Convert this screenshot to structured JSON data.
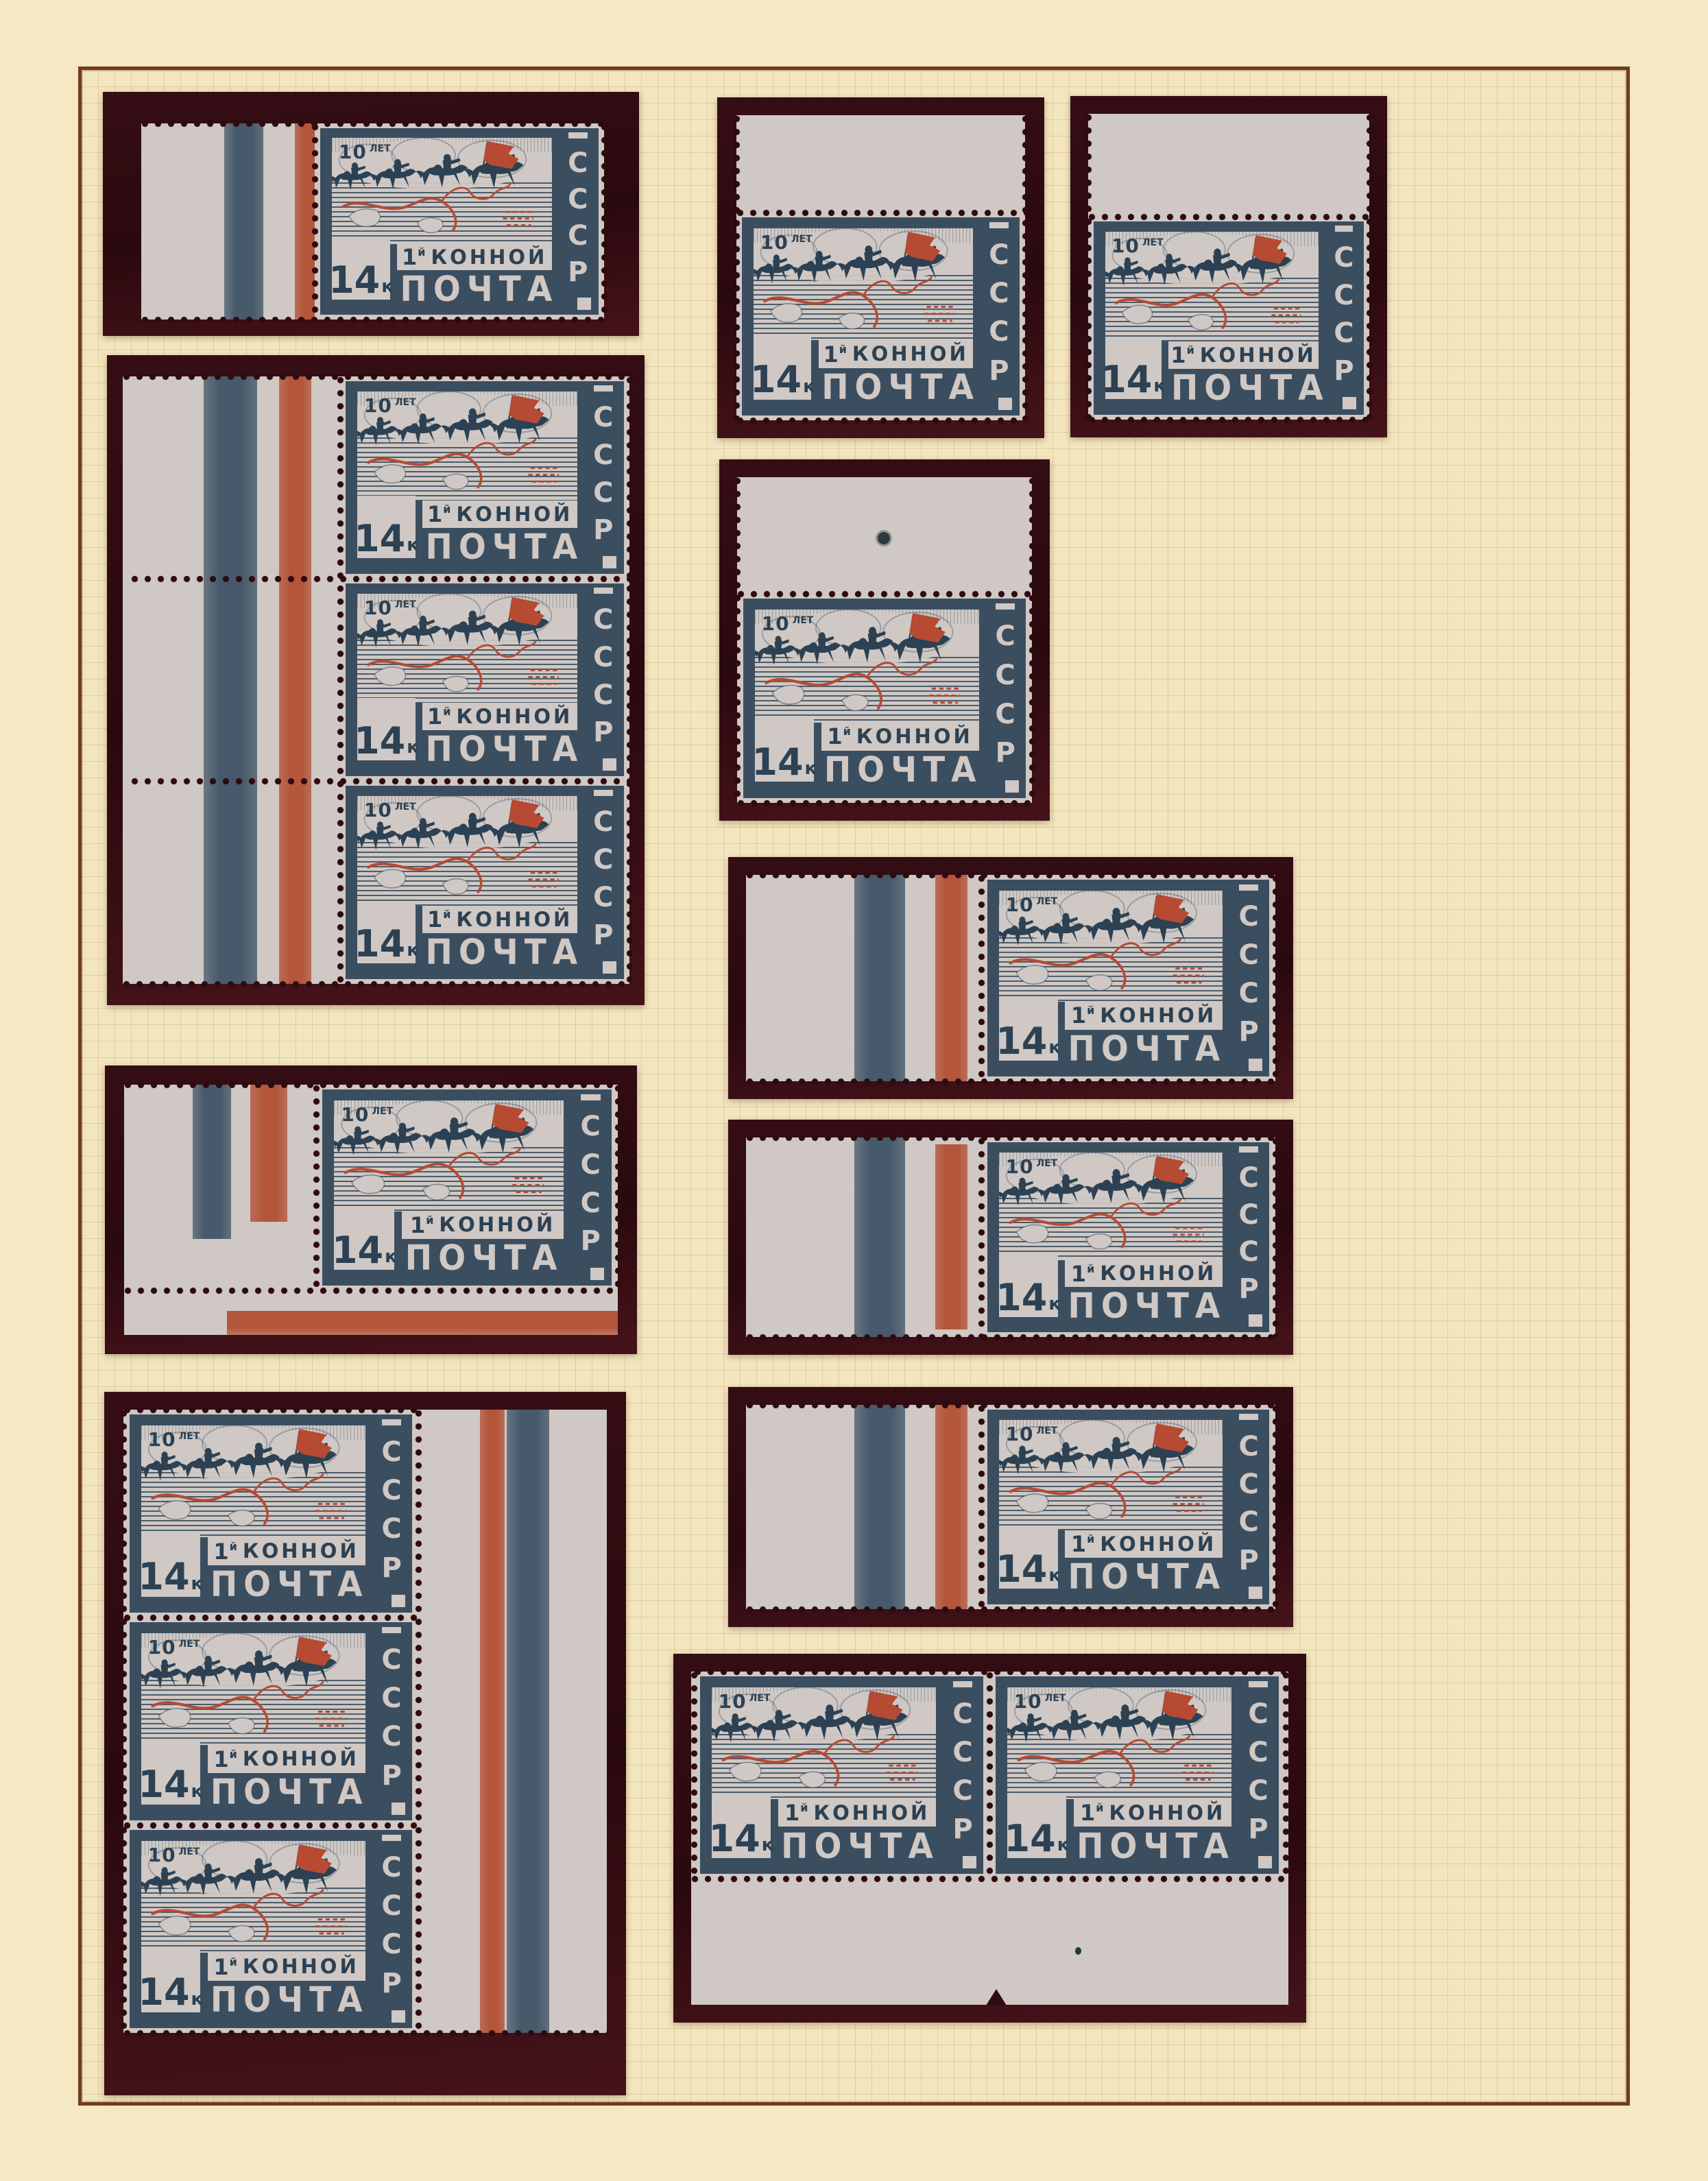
{
  "page": {
    "type": "stamp-album-page",
    "background": "#f5e8c3",
    "frame_color": "#6f3c1d",
    "grid_color": "#b8925c",
    "mount_color": "#2e0b10",
    "paper_color": "#cfc8c4",
    "stamp_blue": "#3b4e60",
    "stamp_ink": "#2c4153",
    "stamp_red": "#b64a33"
  },
  "stamp": {
    "anniversary_big": "10",
    "anniversary_small": "ЛЕТ",
    "country_letters": [
      "С",
      "С",
      "С",
      "Р"
    ],
    "denomination_big": "14",
    "denomination_small": "к",
    "cavalry_prefix": "1",
    "cavalry_sup": "й",
    "cavalry_word": "КОННОЙ",
    "post_word": "ПОЧТА"
  },
  "items": [
    {
      "id": "i1",
      "label": "single with left sheet margin, blue and red color bars",
      "stamps": 1
    },
    {
      "id": "i2",
      "label": "vertical strip of three with left sheet margin, blue and red color bars",
      "stamps": 3
    },
    {
      "id": "i3",
      "label": "corner single with left and bottom sheet margins, color bars",
      "stamps": 1
    },
    {
      "id": "i4",
      "label": "vertical strip of three with right sheet margin, red and blue color bars",
      "stamps": 3
    },
    {
      "id": "i5",
      "label": "single with top sheet margin",
      "stamps": 1
    },
    {
      "id": "i6",
      "label": "single with top sheet margin",
      "stamps": 1
    },
    {
      "id": "i7",
      "label": "single with top sheet margin and punch hole",
      "stamps": 1
    },
    {
      "id": "i8",
      "label": "single with left sheet margin, blue and red color bars",
      "stamps": 1
    },
    {
      "id": "i9",
      "label": "single with left sheet margin, blue and red color bars",
      "stamps": 1
    },
    {
      "id": "i10",
      "label": "single with left sheet margin, blue and red color bars",
      "stamps": 1
    },
    {
      "id": "i11",
      "label": "horizontal pair with bottom sheet margin",
      "stamps": 2
    }
  ]
}
